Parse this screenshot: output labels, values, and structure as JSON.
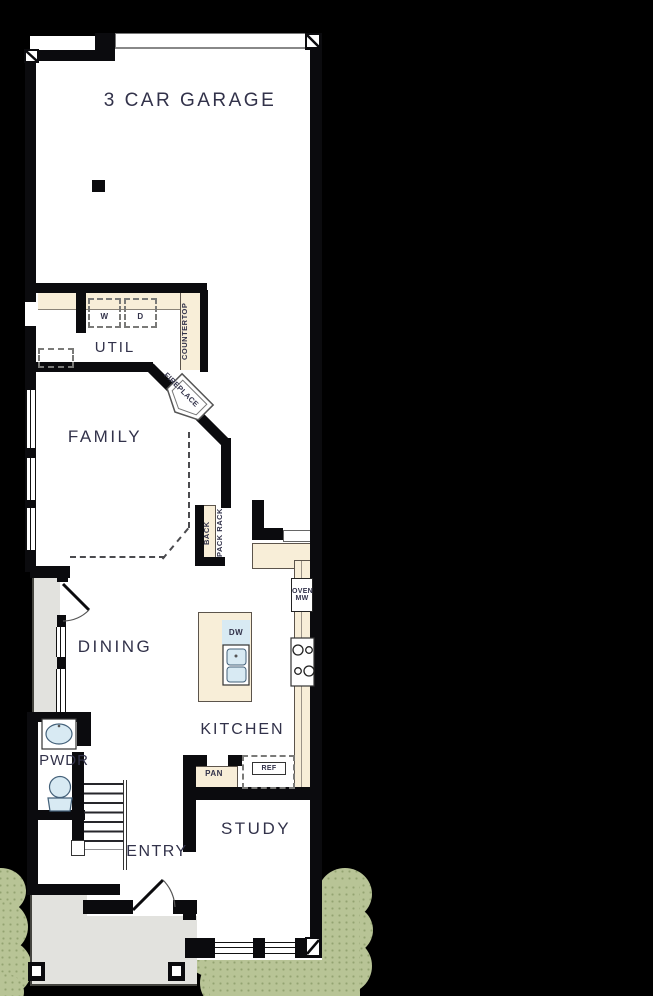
{
  "rooms": {
    "garage": "3 CAR GARAGE",
    "util": "UTIL",
    "family": "FAMILY",
    "dining": "DINING",
    "kitchen": "KITCHEN",
    "pwdr": "PWDR",
    "entry": "ENTRY",
    "study": "STUDY"
  },
  "fixtures": {
    "washer": "W",
    "dryer": "D",
    "countertop": "COUNTERTOP",
    "fireplace": "FIREPLACE",
    "backpack_col1": "BACK",
    "backpack_col2": "PACK RACK",
    "dishwasher": "DW",
    "oven": "OVEN",
    "microwave": "MW",
    "pantry": "PAN",
    "refrigerator": "REF"
  },
  "colors": {
    "background": "#000000",
    "wall": "#0b0b0e",
    "floor": "#ffffff",
    "counter": "#f8eed8",
    "appliance_fill": "#d8eaf3",
    "patio": "#e2e2de",
    "shrub": "#b8c496",
    "label_text": "#32324a"
  }
}
